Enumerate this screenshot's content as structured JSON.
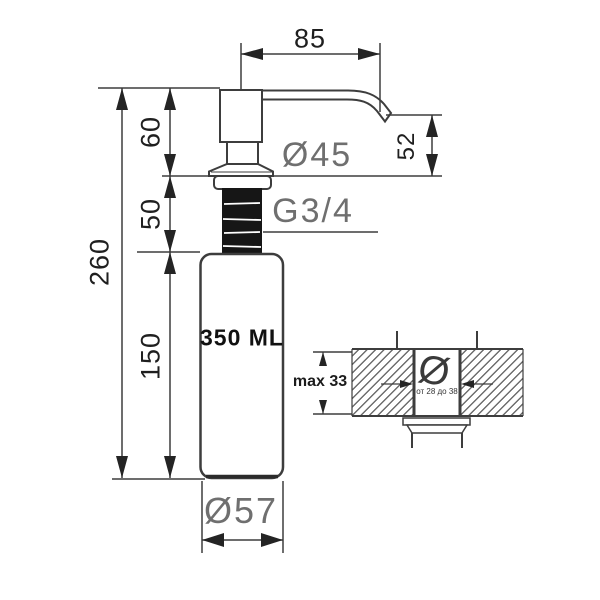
{
  "drawing": {
    "type": "technical-dimension-drawing",
    "subject": "kitchen soap dispenser",
    "labels": {
      "spout_length": "85",
      "head_height": "60",
      "thread_length": "50",
      "total_height": "260",
      "bottle_height": "150",
      "spout_drop": "52",
      "flange_diameter": "Ø45",
      "thread_size": "G3/4",
      "bottle_capacity": "350 ML",
      "bottle_diameter": "Ø57"
    },
    "detail_view": {
      "counter_max_thickness": "max 33",
      "hole_diameter_symbol": "Ø",
      "hole_diameter_range": "от 28 до 38"
    },
    "colors": {
      "background": "#ffffff",
      "line": "#3d3d3d",
      "arrow_fill": "#242424",
      "gray_label": "#6f6f6f",
      "black_text": "#1f1f1f",
      "thread_fill": "#161616",
      "hatch": "#6d6d6d"
    }
  }
}
